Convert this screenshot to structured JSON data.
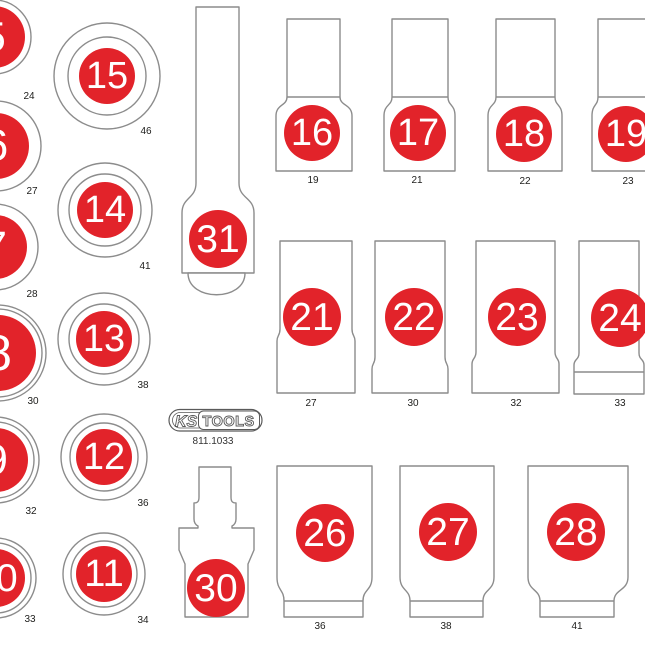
{
  "part_number": "811.1033",
  "brand": {
    "ks": "KS",
    "tools": "TOOLS"
  },
  "colors": {
    "red": "#e2232a",
    "outline": "#8c8c8c",
    "text": "#1d1d1b"
  },
  "left_circles": [
    {
      "number": "5",
      "diameter_label": "24"
    },
    {
      "number": "6",
      "diameter_label": "27"
    },
    {
      "number": "7",
      "diameter_label": "28"
    },
    {
      "number": "8",
      "diameter_label": "30"
    },
    {
      "number": "9",
      "diameter_label": "32"
    },
    {
      "number": "10",
      "diameter_label": "33"
    }
  ],
  "ring_circles": [
    {
      "number": "15",
      "diameter_label": "46"
    },
    {
      "number": "14",
      "diameter_label": "41"
    },
    {
      "number": "13",
      "diameter_label": "38"
    },
    {
      "number": "12",
      "diameter_label": "36"
    },
    {
      "number": "11",
      "diameter_label": "34"
    }
  ],
  "tools": [
    {
      "number": "31"
    },
    {
      "number": "30"
    }
  ],
  "sockets_top": [
    {
      "number": "16",
      "diameter_label": "19"
    },
    {
      "number": "17",
      "diameter_label": "21"
    },
    {
      "number": "18",
      "diameter_label": "22"
    },
    {
      "number": "19",
      "diameter_label": "23"
    }
  ],
  "sockets_mid": [
    {
      "number": "21",
      "diameter_label": "27"
    },
    {
      "number": "22",
      "diameter_label": "30"
    },
    {
      "number": "23",
      "diameter_label": "32"
    },
    {
      "number": "24",
      "diameter_label": "33"
    }
  ],
  "sockets_bottom": [
    {
      "number": "26",
      "diameter_label": "36"
    },
    {
      "number": "27",
      "diameter_label": "38"
    },
    {
      "number": "28",
      "diameter_label": "41"
    }
  ]
}
